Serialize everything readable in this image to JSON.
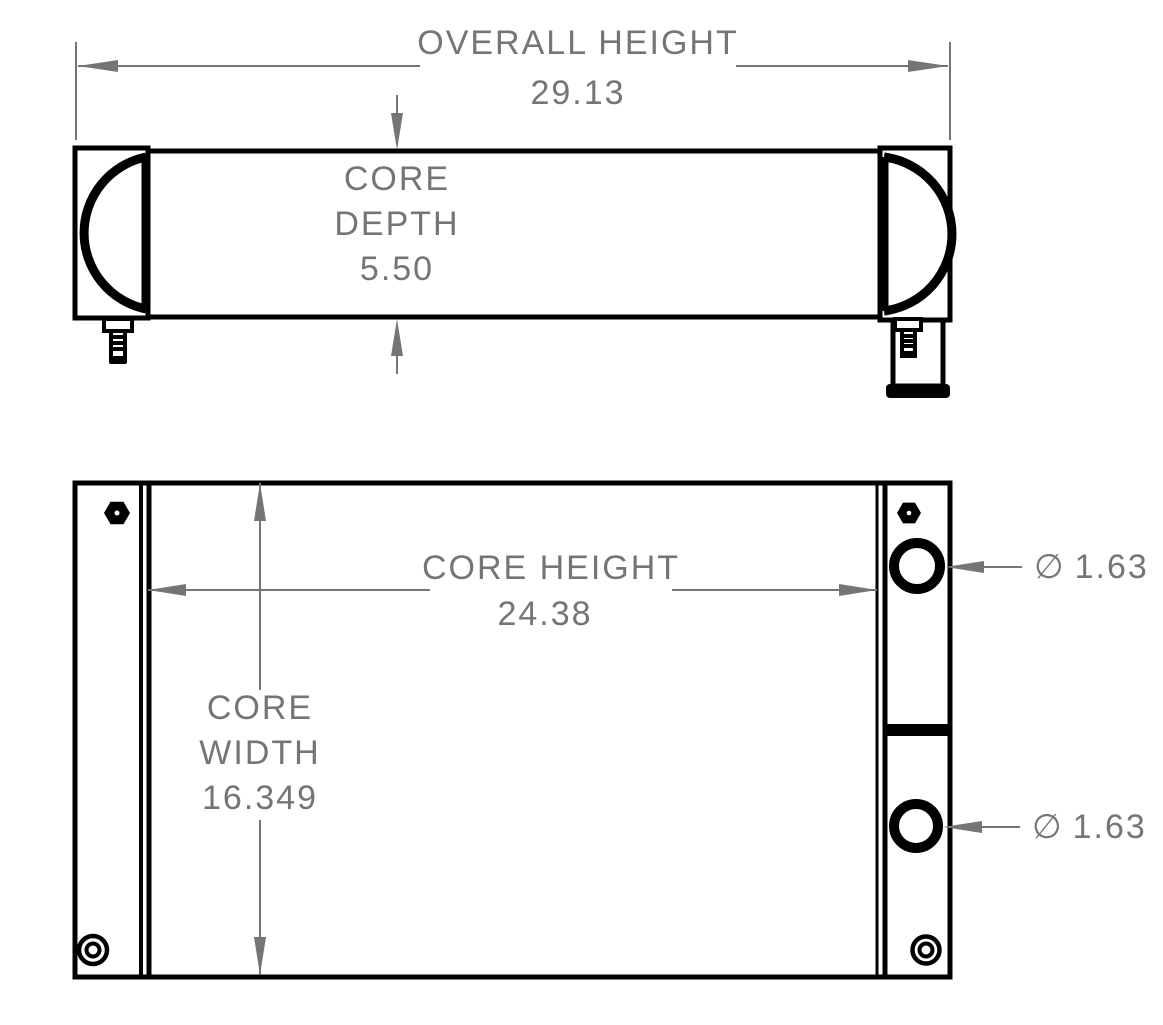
{
  "colors": {
    "background": "#ffffff",
    "drawing_line": "#000000",
    "dimension_gray": "#757575"
  },
  "dimensions": {
    "overall_height": {
      "label": "OVERALL HEIGHT",
      "value": "29.13"
    },
    "core_depth": {
      "label_lines": [
        "CORE",
        "DEPTH"
      ],
      "value": "5.50"
    },
    "core_height": {
      "label": "CORE HEIGHT",
      "value": "24.38"
    },
    "core_width": {
      "label_lines": [
        "CORE",
        "WIDTH"
      ],
      "value": "16.349"
    },
    "port_upper": {
      "symbol": "∅",
      "value": "1.63"
    },
    "port_lower": {
      "symbol": "∅",
      "value": "1.63"
    }
  }
}
